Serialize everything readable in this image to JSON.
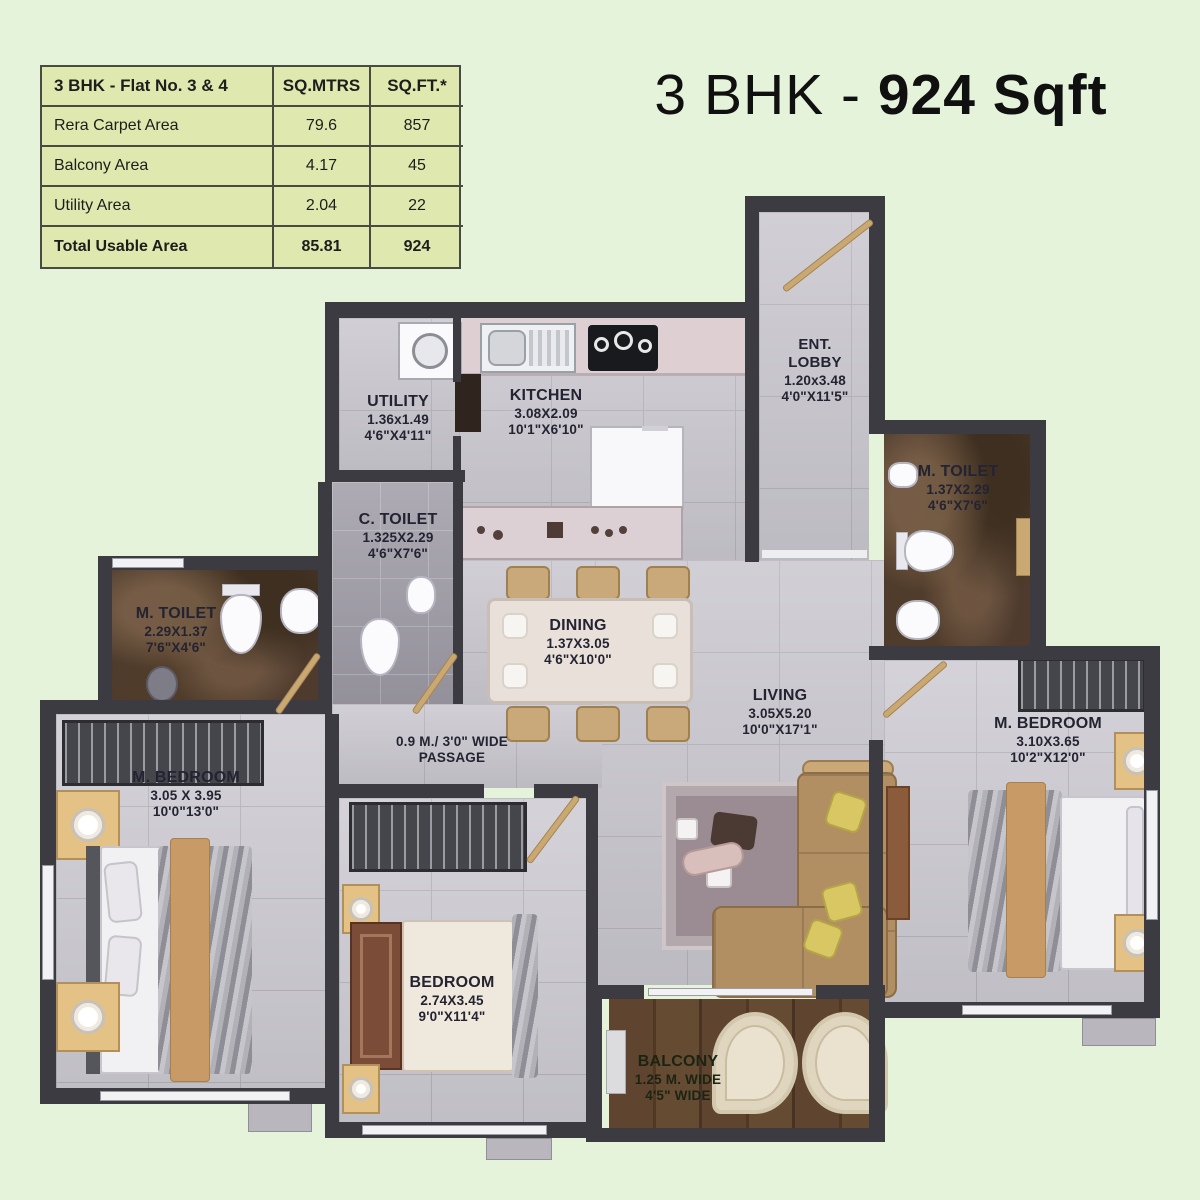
{
  "title": {
    "prefix": "3 BHK - ",
    "bold": "924 Sqft"
  },
  "area_table": {
    "header": [
      "3 BHK - Flat No. 3 & 4",
      "SQ.MTRS",
      "SQ.FT.*"
    ],
    "rows": [
      {
        "label": "Rera Carpet Area",
        "sqm": "79.6",
        "sqft": "857"
      },
      {
        "label": "Balcony Area",
        "sqm": "4.17",
        "sqft": "45"
      },
      {
        "label": "Utility Area",
        "sqm": "2.04",
        "sqft": "22"
      },
      {
        "label": "Total Usable Area",
        "sqm": "85.81",
        "sqft": "924"
      }
    ]
  },
  "rooms": [
    {
      "name": "UTILITY",
      "dim_m": "1.36x1.49",
      "dim_ft": "4'6\"X4'11\""
    },
    {
      "name": "KITCHEN",
      "dim_m": "3.08X2.09",
      "dim_ft": "10'1\"X6'10\""
    },
    {
      "name": "ENT. LOBBY",
      "dim_m": "1.20x3.48",
      "dim_ft": "4'0\"X11'5\""
    },
    {
      "name": "C. TOILET",
      "dim_m": "1.325X2.29",
      "dim_ft": "4'6\"X7'6\""
    },
    {
      "name": "M. TOILET",
      "dim_m": "2.29X1.37",
      "dim_ft": "7'6\"X4'6\""
    },
    {
      "name": "M. TOILET",
      "dim_m": "1.37X2.29",
      "dim_ft": "4'6\"X7'6\""
    },
    {
      "name": "DINING",
      "dim_m": "1.37X3.05",
      "dim_ft": "4'6\"X10'0\""
    },
    {
      "name": "LIVING",
      "dim_m": "3.05X5.20",
      "dim_ft": "10'0\"X17'1\""
    },
    {
      "name": "M. BEDROOM",
      "dim_m": "3.05 X 3.95",
      "dim_ft": "10'0\"13'0\""
    },
    {
      "name": "BEDROOM",
      "dim_m": "2.74X3.45",
      "dim_ft": "9'0\"X11'4\""
    },
    {
      "name": "M. BEDROOM",
      "dim_m": "3.10X3.65",
      "dim_ft": "10'2\"X12'0\""
    },
    {
      "name": "BALCONY",
      "dim_m": "1.25 M. WIDE",
      "dim_ft": "4'5\" WIDE"
    },
    {
      "name": "0.9 M./ 3'0\" WIDE",
      "dim_m": "PASSAGE",
      "dim_ft": ""
    }
  ],
  "colors": {
    "background": "#e4f3da",
    "table_bg": "#dfe9af",
    "table_border": "#494a40",
    "wall": "#3b3b41",
    "floor_tile": "#c7c5cc",
    "toilet_marble": "#4e3b2d",
    "balcony_wood": "#5f452f",
    "sofa_tan": "#b28f63",
    "door_wood": "#c9a873",
    "label_text": "#232331"
  }
}
